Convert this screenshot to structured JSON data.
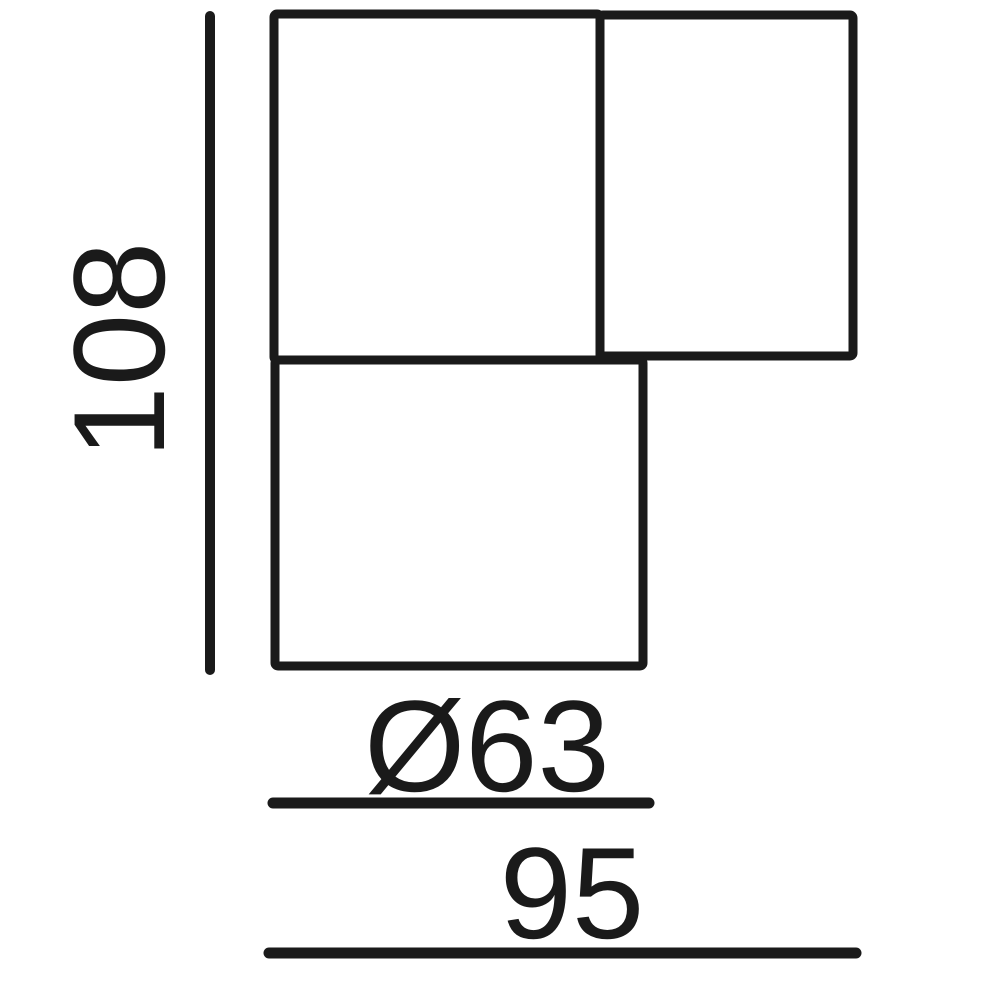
{
  "figure": {
    "type": "technical-dimension-drawing",
    "background_color": "#ffffff",
    "line_color": "#1a1a1a"
  },
  "dimensions": {
    "overall_height": {
      "label": "108",
      "axis": "vertical"
    },
    "diameter": {
      "label": "Ø63",
      "axis": "horizontal"
    },
    "overall_width": {
      "label": "95",
      "axis": "horizontal"
    }
  }
}
